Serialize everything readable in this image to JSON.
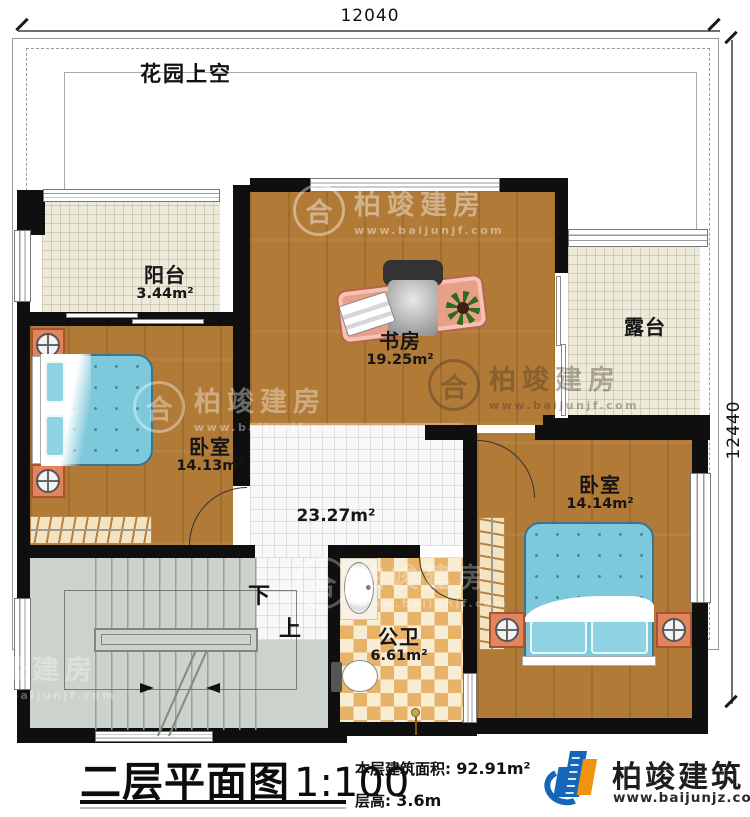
{
  "dimensions": {
    "top": "12040",
    "right": "12440"
  },
  "garden": {
    "label": "花园上空"
  },
  "rooms": {
    "balcony": {
      "name": "阳台",
      "area": "3.44m²"
    },
    "study": {
      "name": "书房",
      "area": "19.25m²"
    },
    "terrace": {
      "name": "露台"
    },
    "bedroom_left": {
      "name": "卧室",
      "area": "14.13m²"
    },
    "bedroom_right": {
      "name": "卧室",
      "area": "14.14m²"
    },
    "hall": {
      "area": "23.27m²"
    },
    "bathroom": {
      "name": "公卫",
      "area": "6.61m²"
    }
  },
  "stairs": {
    "down_label": "下",
    "up_label": "上"
  },
  "title_block": {
    "title": "二层平面图",
    "scale": "1:100",
    "area_label": "本层建筑面积:",
    "area_value": "92.91m²",
    "floor_height_label": "层高:",
    "floor_height_value": "3.6m"
  },
  "brand": {
    "name": "柏竣建筑",
    "website": "www.baijunjz.com"
  },
  "watermark": {
    "name": "柏竣建房",
    "website": "www.baijunjf.com",
    "monogram": "合"
  },
  "colors": {
    "wall": "#0f0f0f",
    "wood_floor": "#b17a36",
    "cream_tile": "#eeead9",
    "white_tile": "#f8f8f8",
    "bathroom_tile": "#e7b369",
    "stair_floor": "#ccd3cc",
    "bed_blue": "#7ec8dc",
    "desk_salmon": "#e89f8a",
    "brand_blue": "#1565b8",
    "brand_orange": "#f0940f"
  }
}
